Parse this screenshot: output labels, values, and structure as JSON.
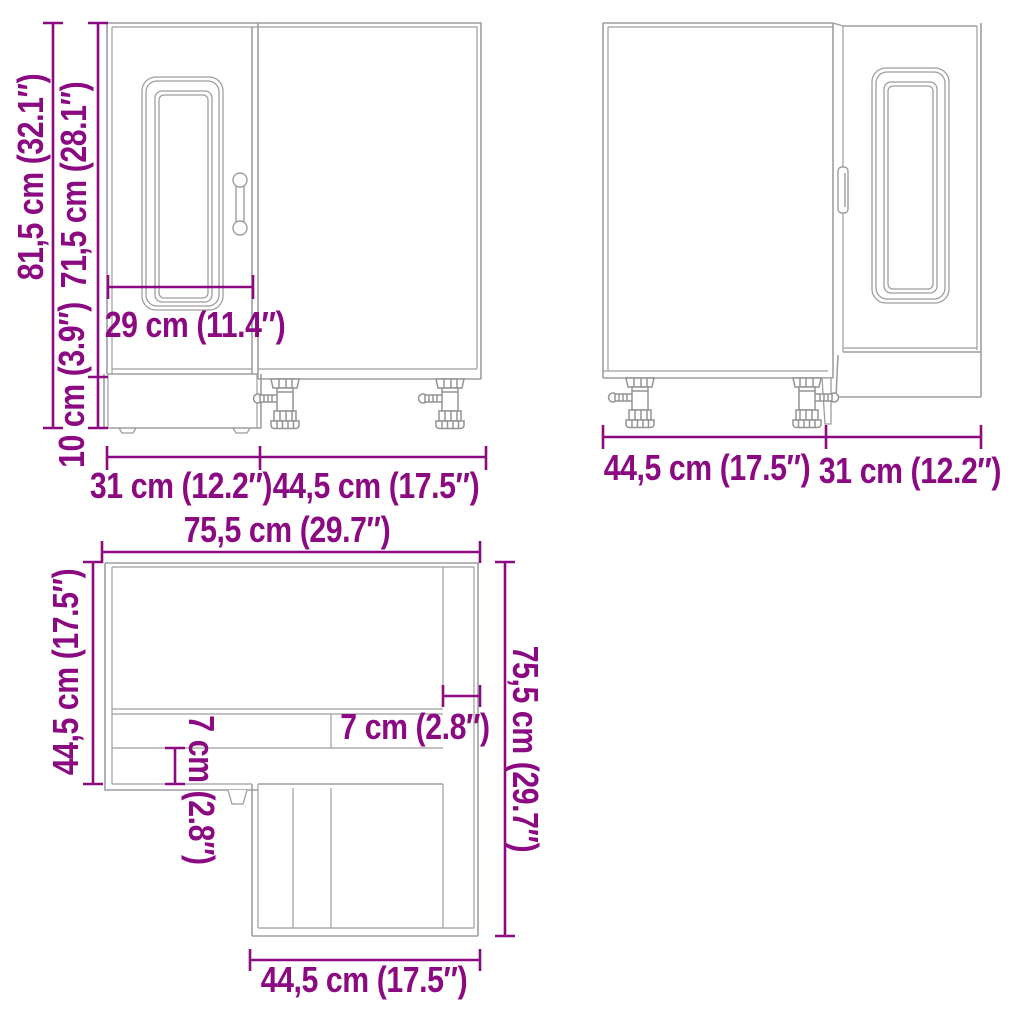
{
  "colors": {
    "dimension_accent": "#8b0a82",
    "drawing_line": "#9e9e9e",
    "background": "#ffffff"
  },
  "views": {
    "front": {
      "name": "front view",
      "labels": {
        "total_height": "81,5 cm (32.1″)",
        "cabinet_height": "71,5 cm (28.1″)",
        "leg_height": "10 cm (3.9″)",
        "door_width": "29 cm (11.4″)",
        "left_width": "31 cm (12.2″)",
        "right_width": "44,5 cm (17.5″)"
      }
    },
    "back": {
      "name": "rear view",
      "labels": {
        "left_width": "44,5 cm (17.5″)",
        "right_width": "31 cm (12.2″)"
      }
    },
    "top": {
      "name": "top view",
      "labels": {
        "top_width": "75,5 cm (29.7″)",
        "left_depth": "44,5 cm (17.5″)",
        "right_depth": "75,5 cm (29.7″)",
        "corner_offset_horizontal": "7 cm (2.8″)",
        "corner_offset_vertical": "7 cm (2.8″)",
        "bottom_width": "44,5 cm (17.5″)"
      }
    }
  }
}
